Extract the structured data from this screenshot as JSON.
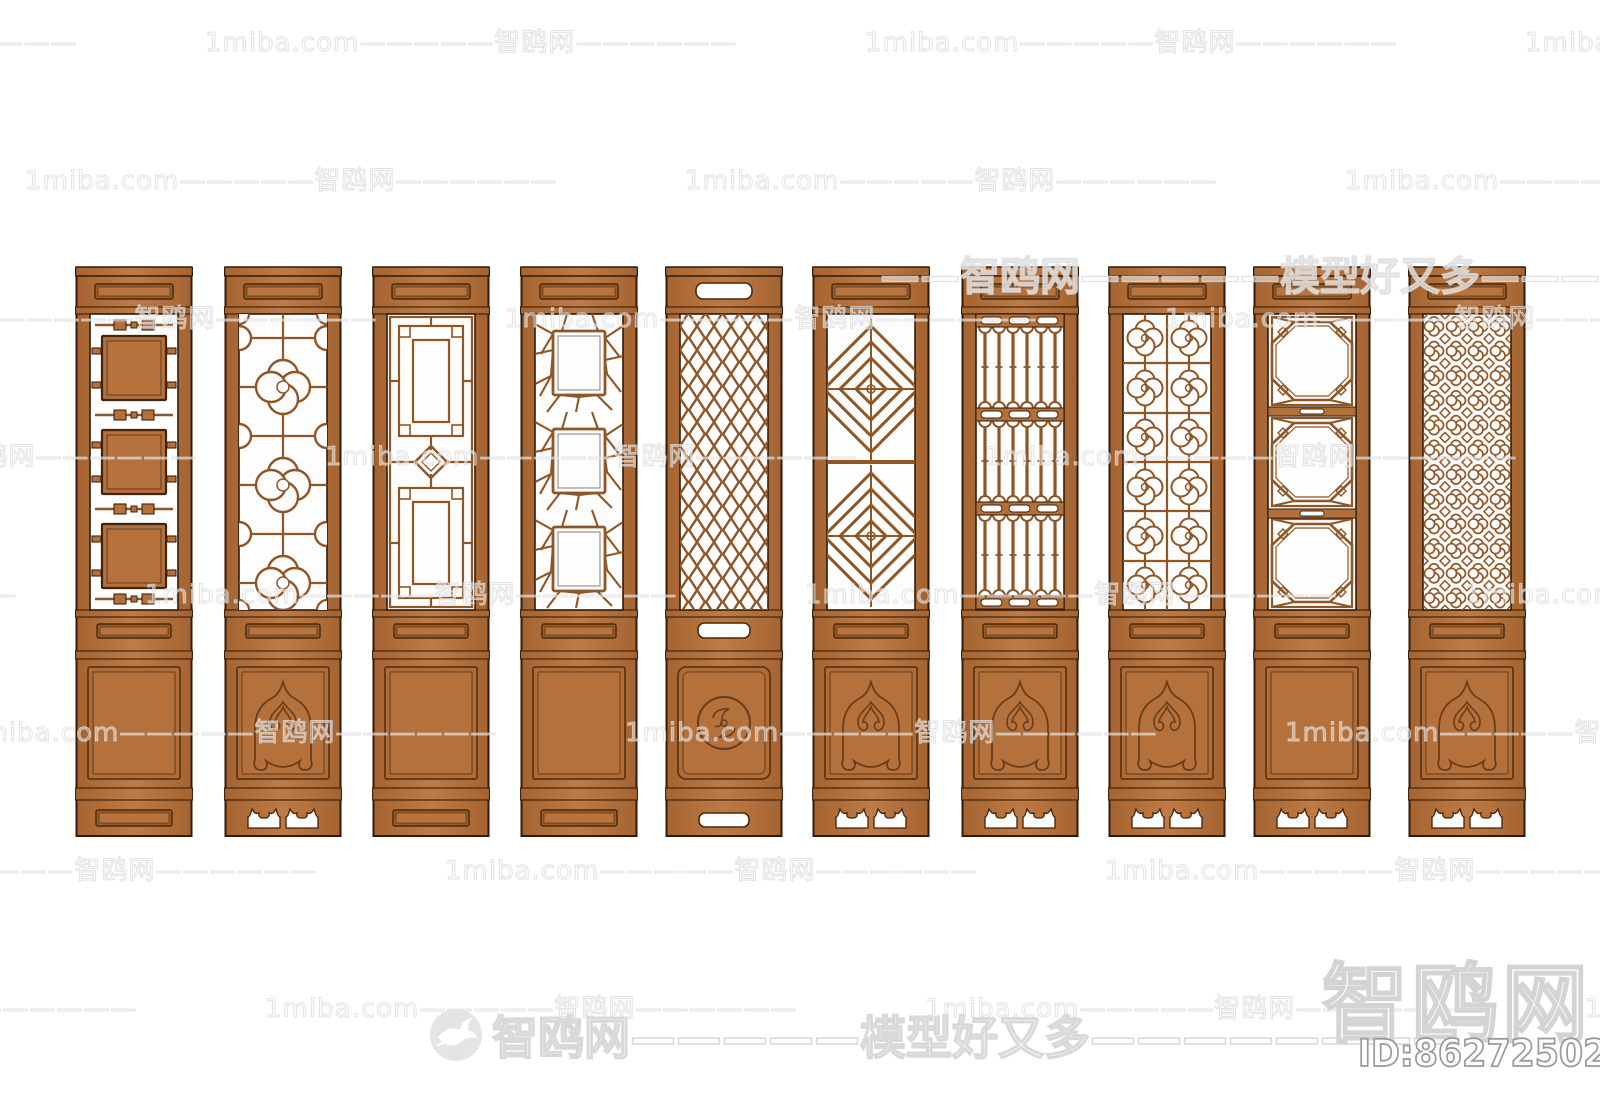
{
  "watermarks": {
    "tile_text": "1miba.com—————智鸥网——————",
    "large_fragment_text": "——智鸥网—————模型好又多————",
    "footer_text": "智鸥网—————模型好又多————————",
    "brand_text": "智鸥网",
    "id_text": "ID:862725029",
    "logo_icon": "seagull-in-circle"
  },
  "colors": {
    "background": "#ffffff",
    "wood_dark_edge": "#a46330",
    "wood_mid": "#b4713c",
    "wood_light": "#bf7b45",
    "outline": "#2f1b0a",
    "groove": "#46290f",
    "lattice": "#8f5626",
    "cutout": "#fdfdfd",
    "watermark_gray": "#d9d9d9"
  },
  "panels": [
    {
      "name": "door-panel-1",
      "pattern": "stacked-squares",
      "top_rail": "inset-bar",
      "middle_rail": "inset-bar",
      "lower_panel": "plain-inset",
      "bottom_rail": "inset-bar"
    },
    {
      "name": "door-panel-2",
      "pattern": "quatrefoil-flower",
      "top_rail": "inset-bar",
      "middle_rail": "inset-bar",
      "lower_panel": "arch-carving",
      "bottom_rail": "cloud-feet-cutouts"
    },
    {
      "name": "door-panel-3",
      "pattern": "square-maze",
      "top_rail": "inset-bar",
      "middle_rail": "inset-bar",
      "lower_panel": "plain-inset",
      "bottom_rail": "inset-bar"
    },
    {
      "name": "door-panel-4",
      "pattern": "ice-crack",
      "top_rail": "inset-bar",
      "middle_rail": "inset-bar",
      "lower_panel": "plain-inset",
      "bottom_rail": "inset-bar"
    },
    {
      "name": "door-panel-5",
      "pattern": "diamond-mesh",
      "top_rail": "slot-cutout",
      "middle_rail": "slot-cutout",
      "lower_panel": "round-medallion",
      "bottom_rail": "slot-cutout"
    },
    {
      "name": "door-panel-6",
      "pattern": "diamond-zigzag",
      "top_rail": "inset-bar",
      "middle_rail": "inset-bar",
      "lower_panel": "arch-carving",
      "bottom_rail": "cloud-feet-cutouts"
    },
    {
      "name": "door-panel-7",
      "pattern": "baluster-rows",
      "top_rail": "inset-bar",
      "middle_rail": "inset-bar",
      "lower_panel": "arch-carving",
      "bottom_rail": "cloud-feet-cutouts"
    },
    {
      "name": "door-panel-8",
      "pattern": "quatrefoil-grid",
      "top_rail": "inset-bar",
      "middle_rail": "inset-bar",
      "lower_panel": "arch-carving",
      "bottom_rail": "cloud-feet-cutouts"
    },
    {
      "name": "door-panel-9",
      "pattern": "octagon-windows",
      "top_rail": "inset-bar",
      "middle_rail": "inset-bar",
      "lower_panel": "plain-inset",
      "bottom_rail": "cloud-feet-cutouts"
    },
    {
      "name": "door-panel-10",
      "pattern": "flower-lattice",
      "top_rail": "inset-bar",
      "middle_rail": "inset-bar",
      "lower_panel": "arch-carving",
      "bottom_rail": "cloud-feet-cutouts"
    }
  ]
}
